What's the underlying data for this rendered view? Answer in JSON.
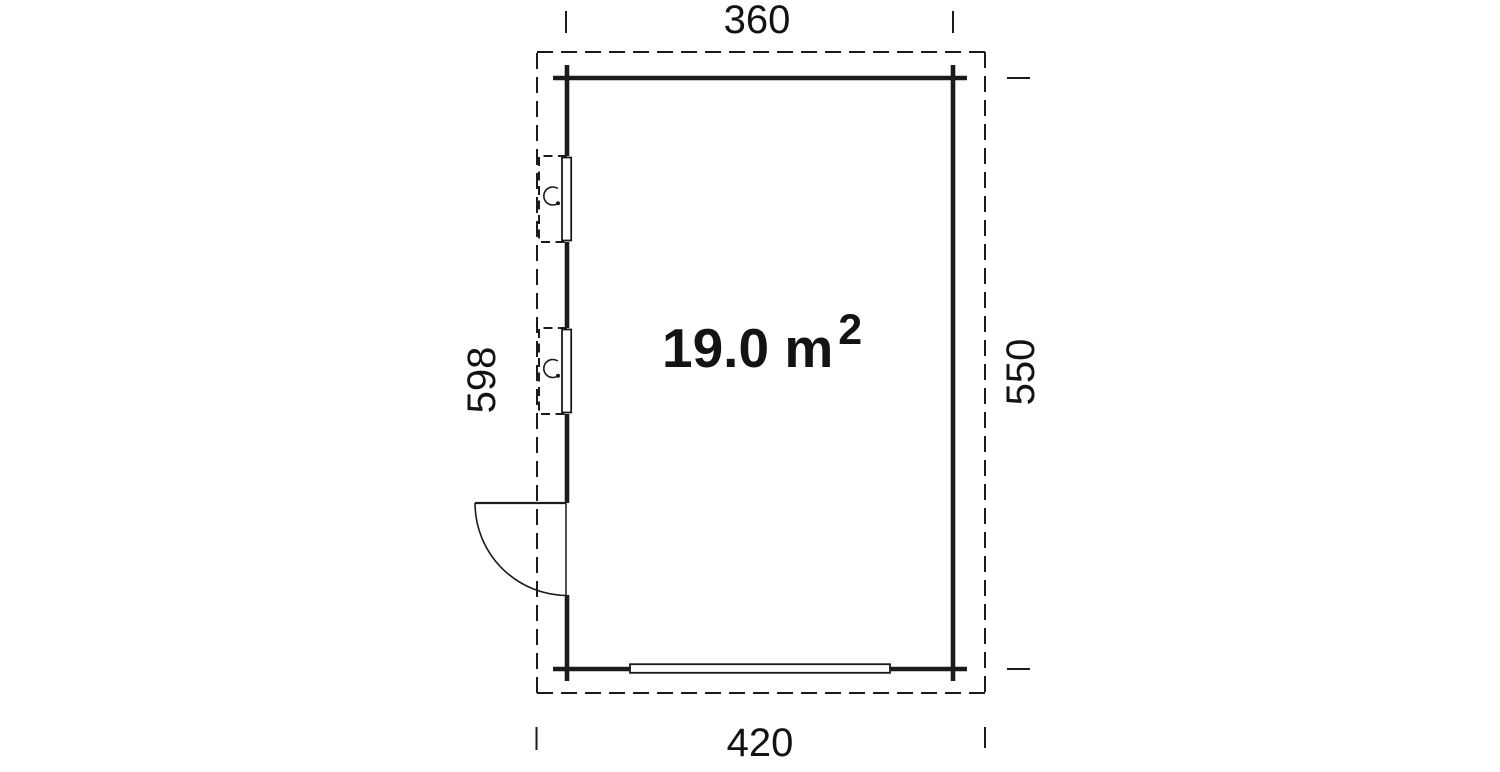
{
  "page": {
    "colors": {
      "background": "#ffffff",
      "line": "#1b1b1b",
      "text": "#131313"
    }
  },
  "floor_plan": {
    "name": "garden house floor plan",
    "area": {
      "main": "19.0 m",
      "superscript": "2",
      "full_label": "19.0 m²"
    },
    "dimensions": {
      "top_width": "360",
      "bottom_width": "420",
      "left_depth": "598",
      "right_depth": "550"
    },
    "icons": {
      "window-tilt-icon": "open arc with end dot (window opening symbol)",
      "door-swing-icon": "quarter-circle swing arc",
      "garage-door-icon": "long thin rectangle in bottom wall"
    }
  }
}
